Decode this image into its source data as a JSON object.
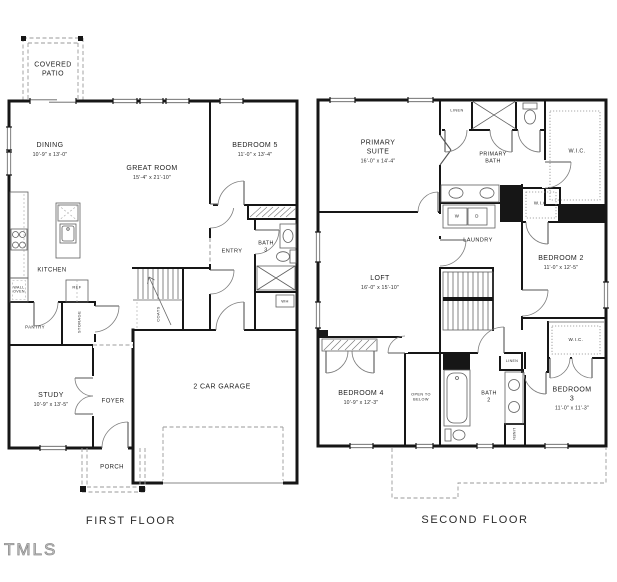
{
  "watermark": "TMLS",
  "first_floor": {
    "title": "FIRST FLOOR",
    "rooms": {
      "covered_patio": {
        "name": "COVERED\nPATIO"
      },
      "dining": {
        "name": "DINING",
        "dims": "10'-9\" x 13'-0\""
      },
      "great_room": {
        "name": "GREAT ROOM",
        "dims": "15'-4\" x 21'-10\""
      },
      "bedroom5": {
        "name": "BEDROOM 5",
        "dims": "11'-0\" x 13'-4\""
      },
      "kitchen": {
        "name": "KITCHEN"
      },
      "study": {
        "name": "STUDY",
        "dims": "10'-9\" x 13'-5\""
      },
      "foyer": {
        "name": "FOYER"
      },
      "porch": {
        "name": "PORCH"
      },
      "garage": {
        "name": "2 CAR GARAGE"
      },
      "entry": {
        "name": "ENTRY"
      },
      "bath3": {
        "name": "BATH\n3"
      }
    },
    "small_labels": {
      "wall_oven": "WALL\nOVEN",
      "ref": "REF",
      "pantry": "PANTRY",
      "storage": "STORAGE",
      "coats": "COATS",
      "wh": "WH"
    }
  },
  "second_floor": {
    "title": "SECOND FLOOR",
    "rooms": {
      "primary_suite": {
        "name": "PRIMARY\nSUITE",
        "dims": "16'-0\" x 14'-4\""
      },
      "primary_bath": {
        "name": "PRIMARY\nBATH"
      },
      "loft": {
        "name": "LOFT",
        "dims": "16'-0\" x 15'-10\""
      },
      "laundry": {
        "name": "LAUNDRY"
      },
      "bedroom2": {
        "name": "BEDROOM 2",
        "dims": "11'-0\" x 12'-5\""
      },
      "bedroom3": {
        "name": "BEDROOM 3",
        "dims": "11'-0\" x 11'-3\""
      },
      "bedroom4": {
        "name": "BEDROOM 4",
        "dims": "10'-9\" x 12'-3\""
      },
      "bath2": {
        "name": "BATH\n2"
      },
      "wic_primary": {
        "name": "W.I.C."
      },
      "wic_hall": {
        "name": "W.I.C."
      },
      "wic_bedroom3": {
        "name": "W.I.C."
      },
      "open_to_below": {
        "name": "OPEN TO\nBELOW"
      }
    },
    "small_labels": {
      "linen_top": "LINEN",
      "linen_bath": "LINEN",
      "linen_side": "LINEN",
      "washer": "W",
      "dryer": "D"
    }
  }
}
